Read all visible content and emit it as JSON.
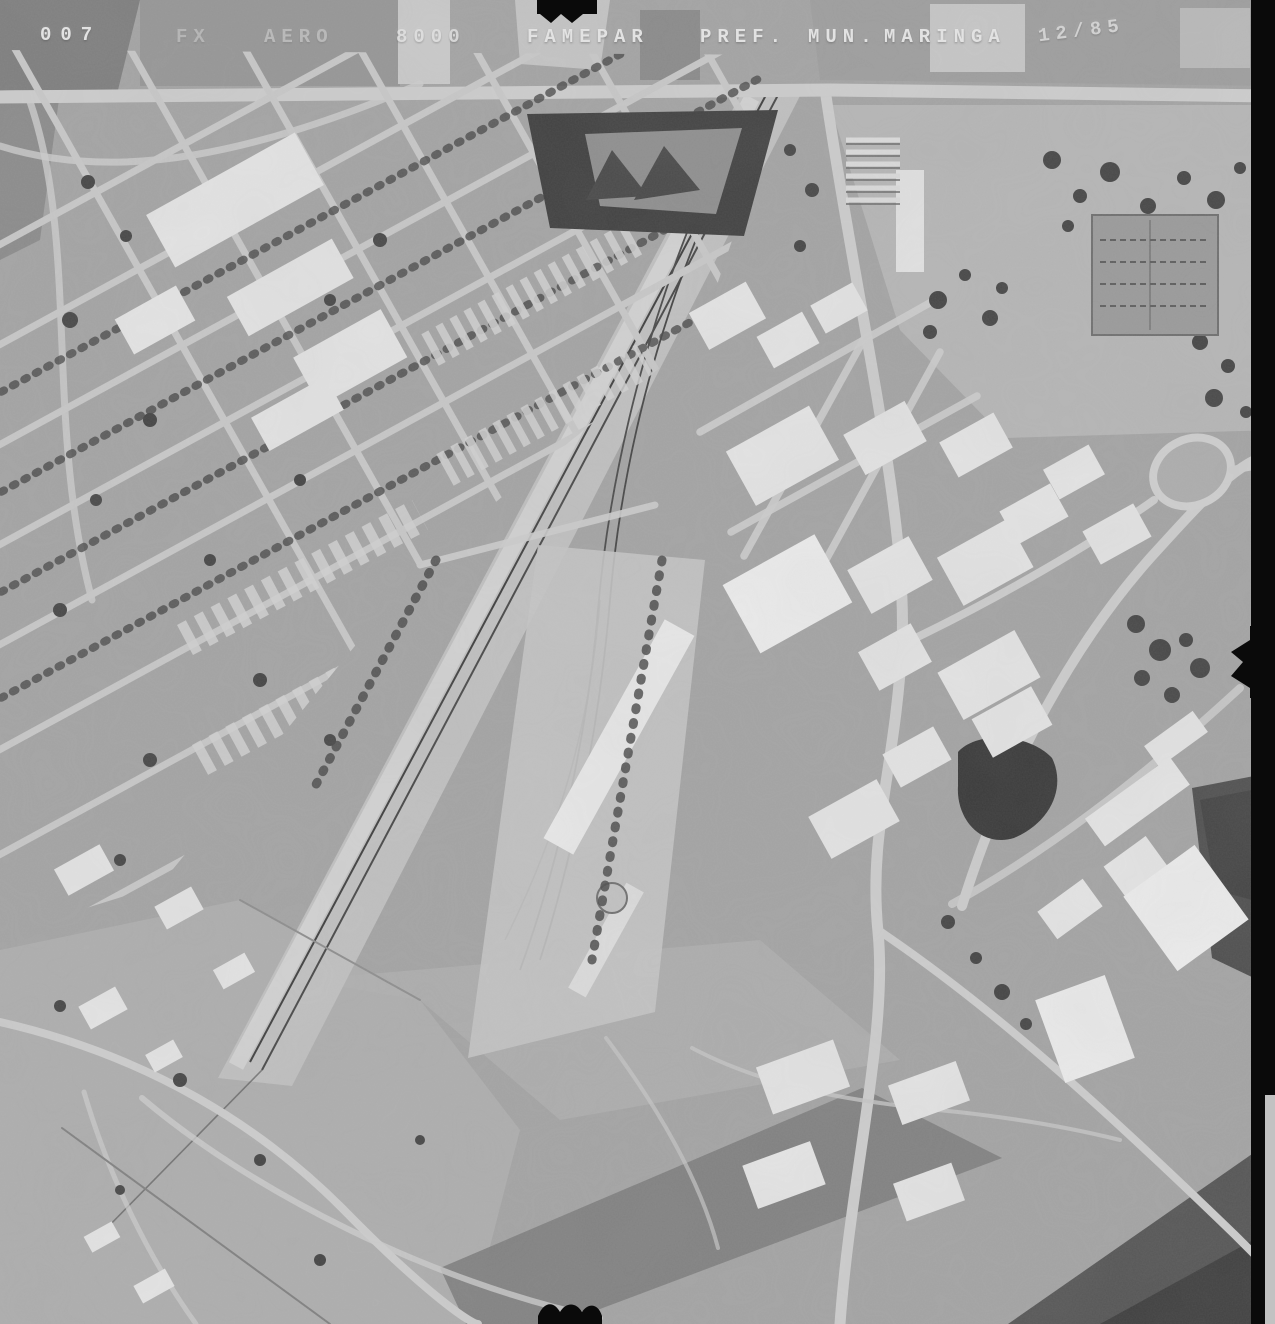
{
  "photo": {
    "kind": "black-and-white vertical aerial survey photograph",
    "scene": "urban and industrial district crossed diagonally by a railway corridor and rail yard, with street grid at upper left and open fields below"
  },
  "annotations": {
    "photo_number": "007",
    "strip": "FX",
    "series": "AERO",
    "scale": "8000",
    "agency": "FAMEPAR",
    "pref": "PREF.",
    "mun": "MUN.",
    "city": "MARINGA",
    "date": "12/85"
  },
  "colors": {
    "annotation_text": "#e2e2e2",
    "film_margin_black": "#0a0a0a",
    "photo_base_gray": "#a4a4a4"
  }
}
